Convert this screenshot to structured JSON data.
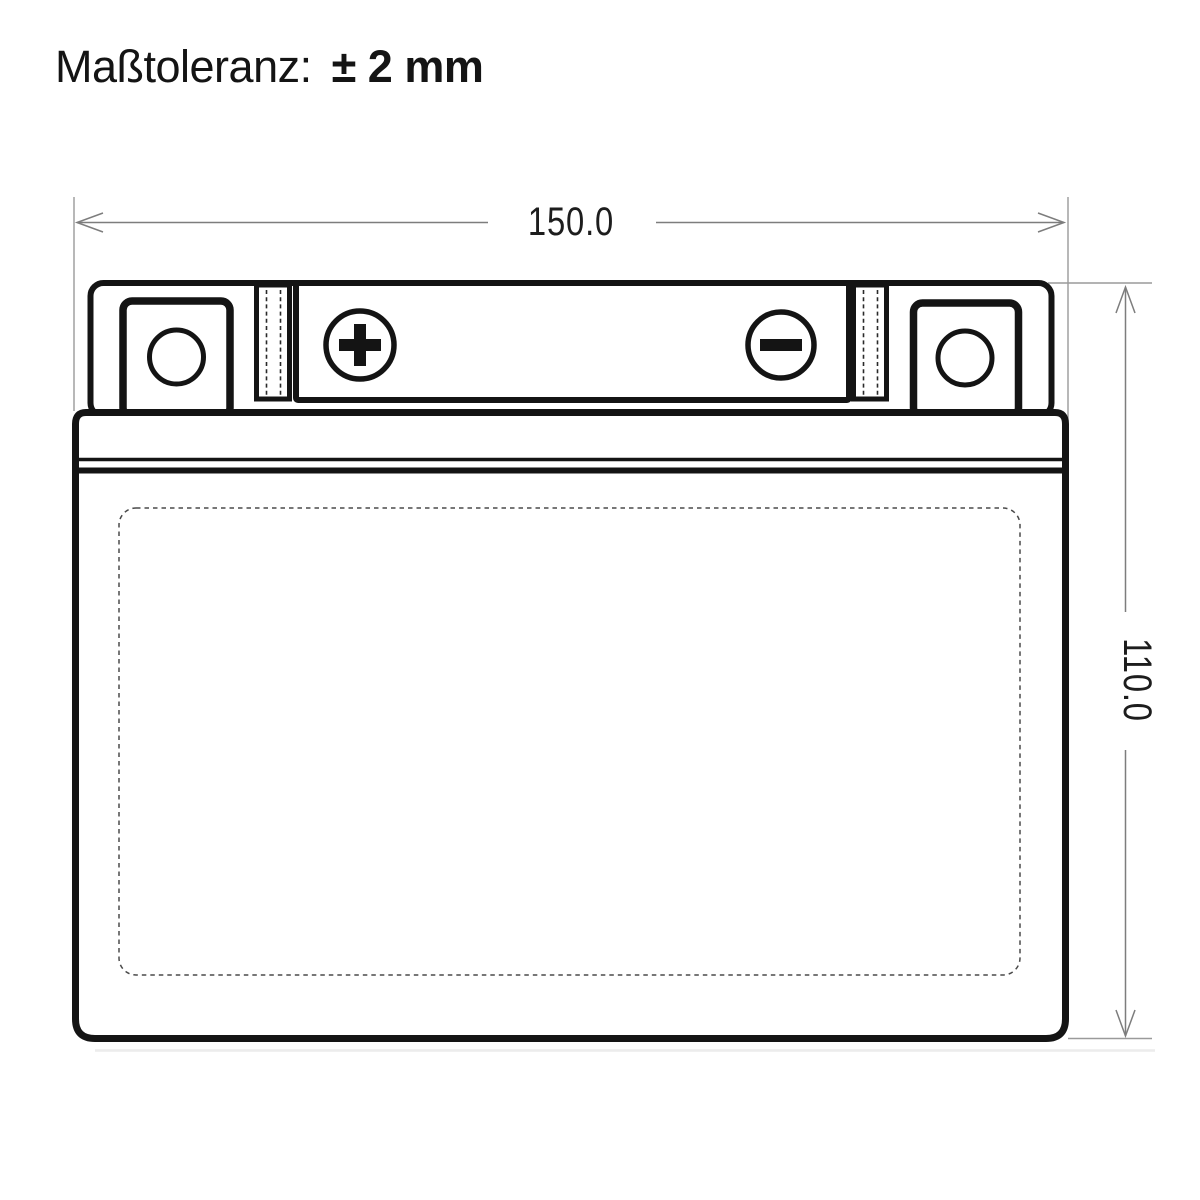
{
  "title": {
    "label": "Maßtoleranz:",
    "value": "± 2 mm"
  },
  "dimensions": {
    "width_mm": "150.0",
    "height_mm": "110.0"
  },
  "drawing": {
    "subject": "battery front view technical drawing",
    "icons": {
      "positive_terminal": "plus-in-circle",
      "negative_terminal": "minus-in-circle",
      "bolt_hole_left": "circle",
      "bolt_hole_right": "circle"
    },
    "colors": {
      "outline": "#141414",
      "dimension_line": "#7d7d7d",
      "dimension_text": "#1d1d1d",
      "background": "#ffffff"
    }
  }
}
